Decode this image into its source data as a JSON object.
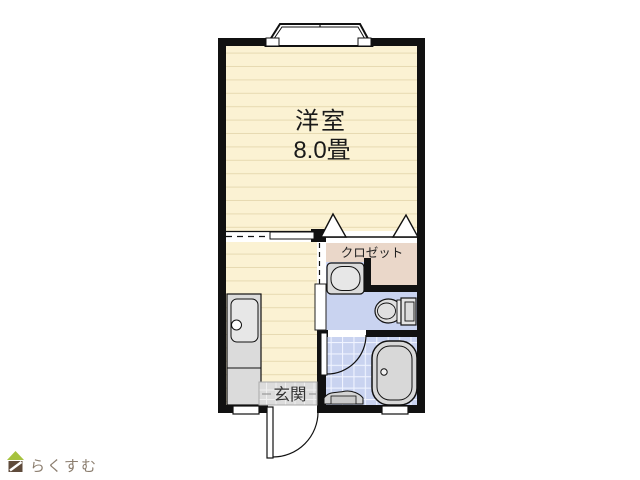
{
  "floorplan": {
    "labels": {
      "main_room_name": "洋室",
      "main_room_size": "8.0畳",
      "closet": "クロゼット",
      "entrance": "玄関"
    },
    "colors": {
      "wall": "#111111",
      "flooring": "#FBF2D3",
      "flooring_line": "#E7DAB2",
      "closet_fill": "#EAD7C9",
      "wet_area_fill": "#C9D3F0",
      "tile_line": "#EFF3FF",
      "fixture_fill": "#DBDBDB",
      "fixture_inner": "#E7E7E7",
      "genkan_fill": "#DCDCDC",
      "label_color": "#1A1A1A"
    },
    "fixtures": [
      "bay-window",
      "closet-folding-doors",
      "sliding-partition",
      "kitchen-sink",
      "washbasin",
      "toilet",
      "bathtub",
      "shower-counter",
      "bathroom-door",
      "toilet-room-door",
      "entrance-door",
      "under-wall-windows"
    ]
  },
  "branding": {
    "logo_text": "らくすむ",
    "logo_colors": {
      "roof": "#A6C23E",
      "body": "#5F4B3B",
      "text": "#8C7E6F"
    }
  }
}
